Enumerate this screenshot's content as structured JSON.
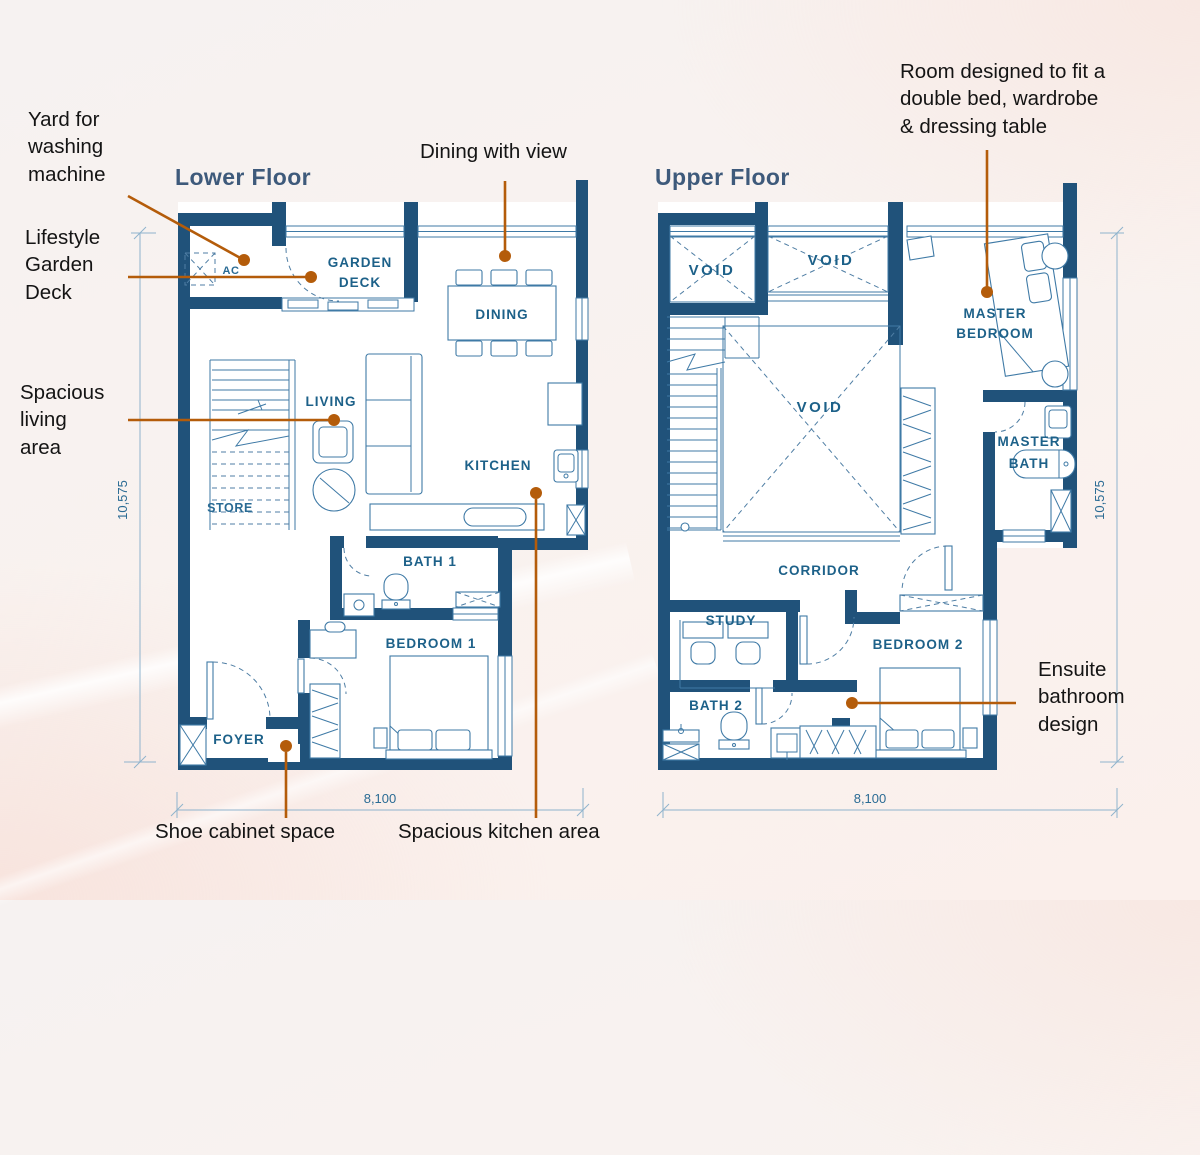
{
  "titles": {
    "lower": "Lower Floor",
    "upper": "Upper Floor"
  },
  "annotations": {
    "yard": "Yard for\nwashing\nmachine",
    "garden_deck": "Lifestyle\nGarden\nDeck",
    "dining_view": "Dining with view",
    "living_area": "Spacious\nliving\narea",
    "shoe_cabinet": "Shoe cabinet space",
    "kitchen_area": "Spacious kitchen area",
    "master_room": "Room designed to fit a\ndouble bed, wardrobe\n& dressing table",
    "ensuite": "Ensuite\nbathroom\ndesign"
  },
  "lower_rooms": {
    "ac": "AC",
    "garden_deck": [
      "GARDEN",
      "DECK"
    ],
    "dining": "DINING",
    "living": "LIVING",
    "kitchen": "KITCHEN",
    "store": "STORE",
    "bath1": "BATH 1",
    "bedroom1": "BEDROOM 1",
    "foyer": "FOYER"
  },
  "upper_rooms": {
    "void1": "VOID",
    "void2": "VOID",
    "void3": "VOID",
    "master_bedroom": [
      "MASTER",
      "BEDROOM"
    ],
    "master_bath": [
      "MASTER",
      "BATH"
    ],
    "corridor": "CORRIDOR",
    "study": "STUDY",
    "bath2": "BATH 2",
    "bedroom2": "BEDROOM 2"
  },
  "dimensions": {
    "lower_height": "10,575",
    "lower_width": "8,100",
    "upper_height": "10,575",
    "upper_width": "8,100"
  },
  "colors": {
    "wall": "#20527a",
    "plan_line": "#3f7aa6",
    "room_label": "#1d6189",
    "floor_title": "#3e5a7b",
    "leader": "#b45c0a",
    "dimension": "#2a6b94",
    "background_tint": "#f9efec"
  }
}
